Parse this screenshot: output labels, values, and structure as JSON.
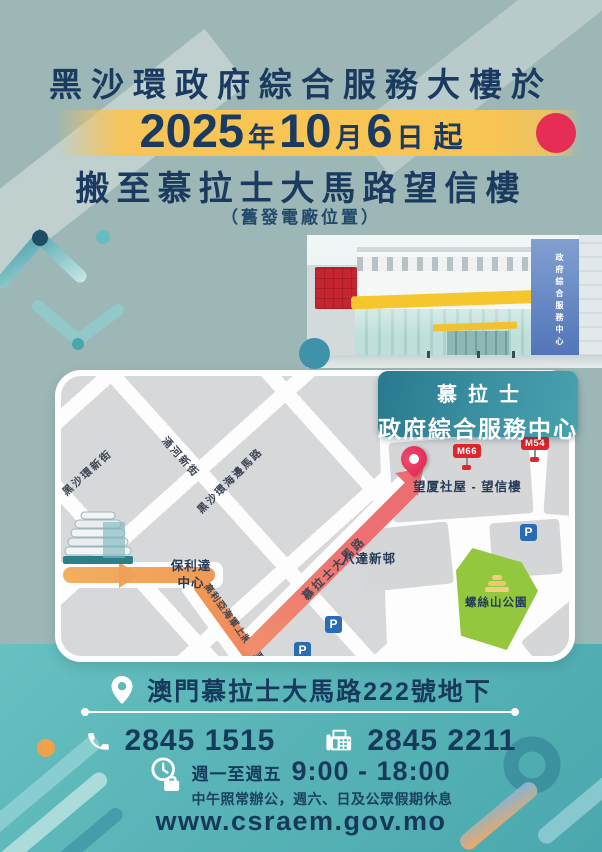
{
  "header": {
    "title": "黑沙環政府綜合服務大樓於",
    "date": {
      "year": "2025",
      "year_unit": "年",
      "month": "10",
      "month_unit": "月",
      "day": "6",
      "day_unit": "日",
      "suffix": "起"
    },
    "subtitle": "搬至慕拉士大馬路望信樓",
    "note": "（舊發電廠位置）"
  },
  "photo": {
    "tower_sign": "政府綜合服務中心"
  },
  "map": {
    "info_box": {
      "line1": "慕拉士",
      "line2": "政府綜合服務中心"
    },
    "streets": {
      "hac_sa_wan_new": "黑沙環新街",
      "chong_ho_new": "涌河新街",
      "hac_sa_wan_seaside": "黑沙環海邊馬路",
      "almirante": "高利亞海軍上將大馬路",
      "venceslau": "慕拉士大馬路"
    },
    "places": {
      "polytec_centre": "保利達中心",
      "mong_ha_block": "望厦社屋 - 望信樓",
      "pat_tat": "八達新邨",
      "park": "螺絲山公園"
    },
    "bus_stops": {
      "m66": "M66",
      "m54": "M54"
    },
    "parking": "P"
  },
  "contact": {
    "address": "澳門慕拉士大馬路222號地下",
    "phone": "2845 1515",
    "fax": "2845 2211",
    "hours_days": "週一至週五",
    "hours_time": "9:00 - 18:00",
    "hours_note": "中午照常辦公，週六、日及公眾假期休息",
    "website": "www.csraem.gov.mo"
  },
  "colors": {
    "navy": "#1a3a60",
    "teal": "#58b4b6",
    "band_yellow": "#f8c454",
    "dot_red": "#e62d56"
  }
}
